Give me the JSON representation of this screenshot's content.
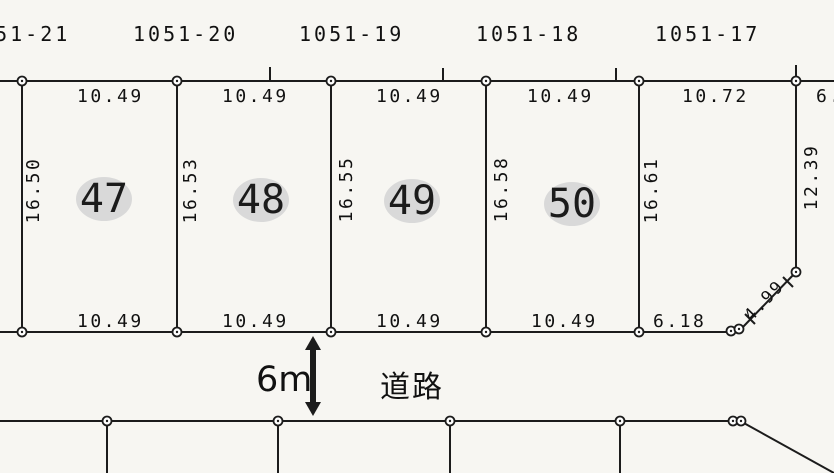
{
  "drawing": {
    "lot_labels": [
      "1051-21",
      "1051-20",
      "1051-19",
      "1051-18",
      "1051-17"
    ],
    "top_dims": [
      "10.49",
      "10.49",
      "10.49",
      "10.49",
      "10.72",
      "6."
    ],
    "bottom_dims": [
      "10.49",
      "10.49",
      "10.49",
      "10.49",
      "6.18"
    ],
    "left_side_dims": [
      "16.50",
      "16.53",
      "16.55",
      "16.58",
      "16.61"
    ],
    "right_side_dim": "12.39",
    "corner_dim": "4.99",
    "plots": [
      "47",
      "48",
      "49",
      "50"
    ],
    "road": {
      "width": "6m",
      "name": "道路"
    },
    "colors": {
      "ink": "#1c1c1c",
      "paper": "#f7f6f2",
      "badge_fill": "#d9d9d9"
    }
  }
}
